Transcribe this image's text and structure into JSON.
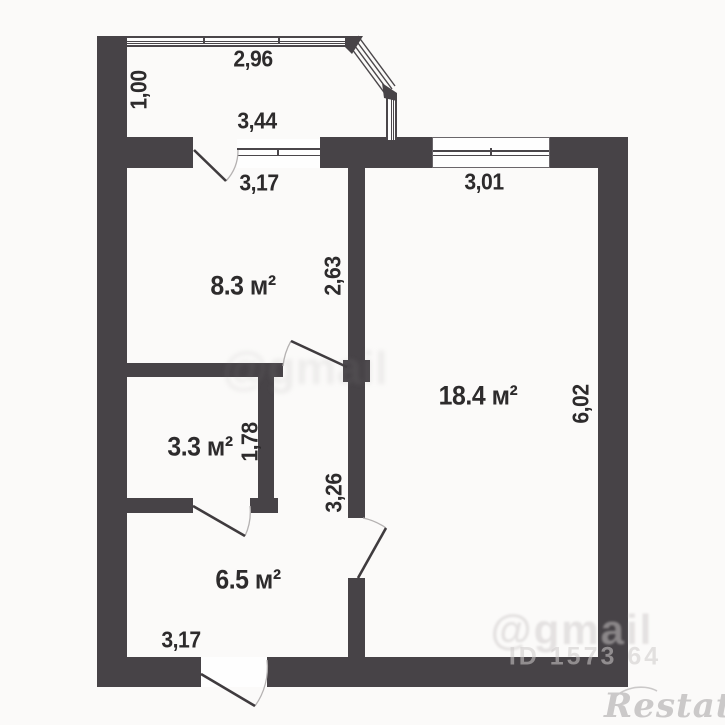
{
  "colors": {
    "wall": "#474347",
    "label_text": "#2d2b2c",
    "window_line": "#4a464a",
    "door_arc": "#b5b2b2",
    "watermark": "#cdcaca",
    "logo": "#cbc9c9",
    "background": "#fbfaf9"
  },
  "balcony": {
    "width_label": "2,96",
    "depth_label": "1,00"
  },
  "rooms": {
    "room_83": {
      "area_label": "8.3 м²",
      "outer_label": "3,44",
      "width_label": "3,17",
      "depth_label": "2,63"
    },
    "room_184": {
      "area_label": "18.4 м²",
      "window_label": "3,01",
      "depth_label": "6,02"
    },
    "room_33": {
      "area_label": "3.3 м²",
      "depth_label": "1,78"
    },
    "hall": {
      "depth_label": "3,26"
    },
    "room_65": {
      "area_label": "6.5 м²",
      "width_label": "3,17"
    }
  },
  "watermarks": {
    "center_text": "@gmail",
    "corner_text": "@gmail",
    "id_text": "ID 1573 64",
    "logo_text": "Restate"
  }
}
